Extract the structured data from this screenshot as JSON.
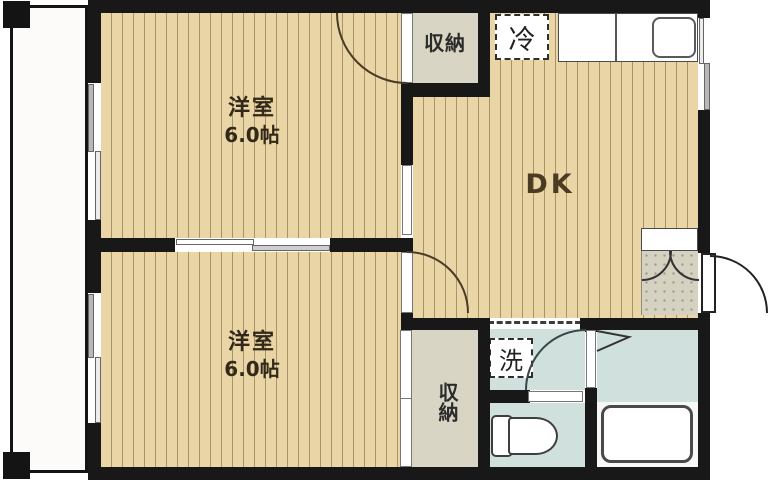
{
  "plan": {
    "title": "1DK apartment floor plan",
    "room1": {
      "name": "洋室",
      "size": "6.0帖"
    },
    "room2": {
      "name": "洋室",
      "size": "6.0帖"
    },
    "dining_kitchen": {
      "label": "DK"
    },
    "closet_top": {
      "label": "収納"
    },
    "closet_bottom": {
      "label": "収納"
    },
    "refrigerator": {
      "label": "冷"
    },
    "laundry": {
      "label": "洗"
    }
  },
  "colors": {
    "wall": "#181818",
    "floor_wood_base": "#e9d5a6",
    "floor_wood_stripe": "#ab9464",
    "closet_fill": "#d8d5c4",
    "wet_room_fill": "#cfe0dd",
    "entrance_tile": "#d6d2c1",
    "balcony_fill": "#fcfbf9"
  }
}
